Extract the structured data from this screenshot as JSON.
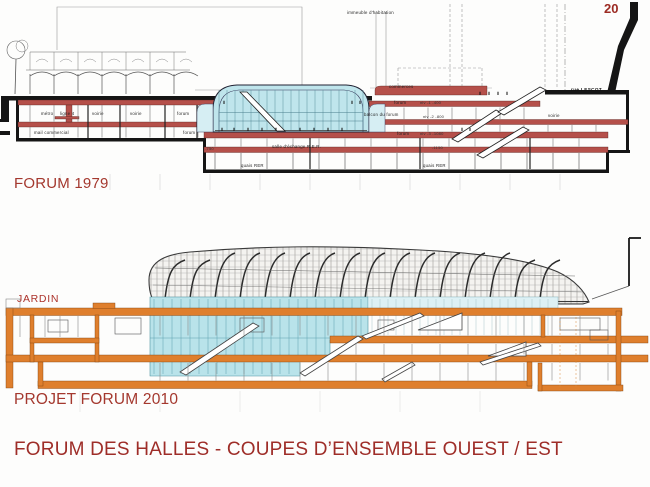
{
  "page": {
    "number": "20",
    "title": "FORUM DES HALLES - COUPES D’ENSEMBLE OUEST / EST"
  },
  "forum1979": {
    "caption": "FORUM 1979",
    "labels": {
      "immeuble": "immeuble d'habitation",
      "commerces": "commerces",
      "metro": "métro",
      "ligne4": "ligne 4",
      "voirie1": "voirie",
      "voirie2": "voirie",
      "forum_a": "forum",
      "mail": "mail commercial",
      "forum_b": "forum",
      "forum_n1": "forum",
      "niv1": "niv -1  -400",
      "balcon": "balcon du forum",
      "niv2": "niv -2  -800",
      "forum_n3": "forum",
      "niv3": "niv -3 -1080",
      "m750": "-750",
      "salle": "salle d'échange  R.E.R.",
      "n1150": "-1150",
      "quais_a": "quais RER",
      "quais_b": "quais RER",
      "rue_lescot": "rue LESCOT",
      "voirie3": "voirie"
    }
  },
  "forum2010": {
    "caption": "PROJET FORUM 2010",
    "jardin": "JARDIN"
  },
  "colors": {
    "caption_red": "#a4382e",
    "title_red": "#9e2d28",
    "band_red": "#b5504a",
    "atrium_cyan": "#bfe5ec",
    "structure_orange": "#df7f2d"
  }
}
